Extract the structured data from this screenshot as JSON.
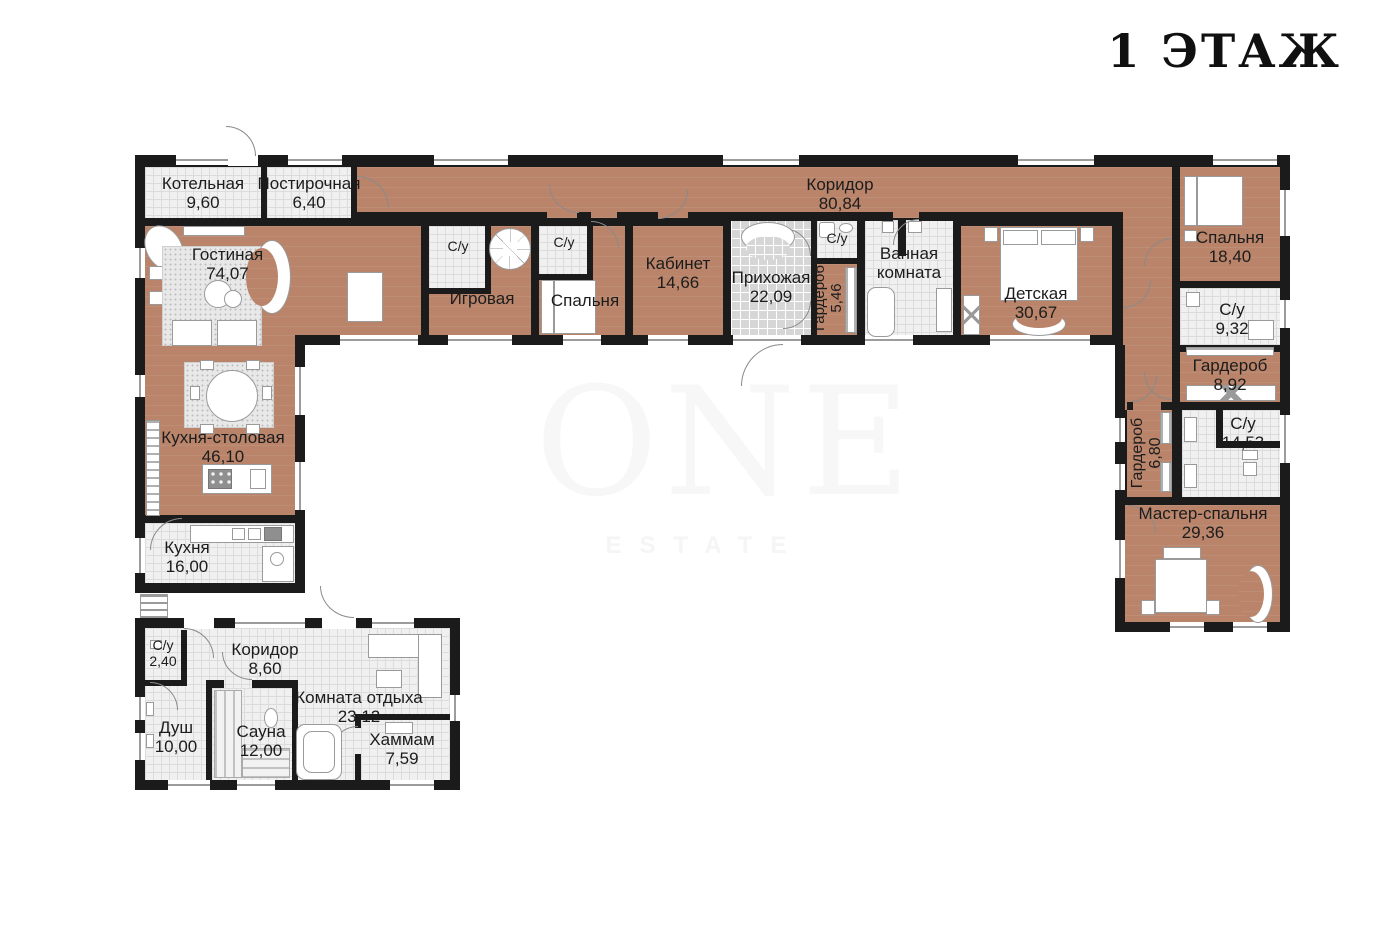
{
  "title": "1 ЭТАЖ",
  "watermark": {
    "line1": "ONE",
    "line2": "ESTATE"
  },
  "colors": {
    "floor_wood": "#b9846a",
    "tile_light": "#f0f0f0",
    "tile_gray": "#d6d6d6",
    "wall": "#1b1b1b",
    "fixture_line": "#9a9a9a"
  },
  "rooms": {
    "kotelnaya": {
      "name": "Котельная",
      "area": "9,60"
    },
    "postirochnaya": {
      "name": "Постирочная",
      "area": "6,40"
    },
    "koridor": {
      "name": "Коридор",
      "area": "80,84"
    },
    "gostinaya": {
      "name": "Гостиная",
      "area": "74,07"
    },
    "su_igrovaya": {
      "name": "С/у"
    },
    "igrovaya": {
      "name": "Игровая"
    },
    "su_spalnya": {
      "name": "С/у"
    },
    "spalnya": {
      "name": "Спальня"
    },
    "kabinet": {
      "name": "Кабинет",
      "area": "14,66"
    },
    "prihozhaya": {
      "name": "Прихожая",
      "area": "22,09"
    },
    "su_hall": {
      "name": "С/у"
    },
    "garderob_hall": {
      "name": "Гардероб",
      "area": "5,46"
    },
    "vannaya": {
      "name": "Ванная комната"
    },
    "detskaya": {
      "name": "Детская",
      "area": "30,67"
    },
    "spalnya2": {
      "name": "Спальня",
      "area": "18,40"
    },
    "su_932": {
      "name": "С/у",
      "area": "9,32"
    },
    "garderob_892": {
      "name": "Гардероб",
      "area": "8,92"
    },
    "garderob_680": {
      "name": "Гардероб",
      "area": "6,80"
    },
    "su_1453": {
      "name": "С/у",
      "area": "14,53"
    },
    "master_spalnya": {
      "name": "Мастер-спальня",
      "area": "29,36"
    },
    "kuhnya_stolovaya": {
      "name": "Кухня-столовая",
      "area": "46,10"
    },
    "kuhnya": {
      "name": "Кухня",
      "area": "16,00"
    },
    "su_240": {
      "name": "С/у",
      "area": "2,40"
    },
    "koridor_sauna": {
      "name": "Коридор",
      "area": "8,60"
    },
    "komnata_otdyha": {
      "name": "Комната отдыха",
      "area": "23,12"
    },
    "dush": {
      "name": "Душ",
      "area": "10,00"
    },
    "sauna": {
      "name": "Сауна",
      "area": "12,00"
    },
    "hammam": {
      "name": "Хаммам",
      "area": "7,59"
    }
  }
}
